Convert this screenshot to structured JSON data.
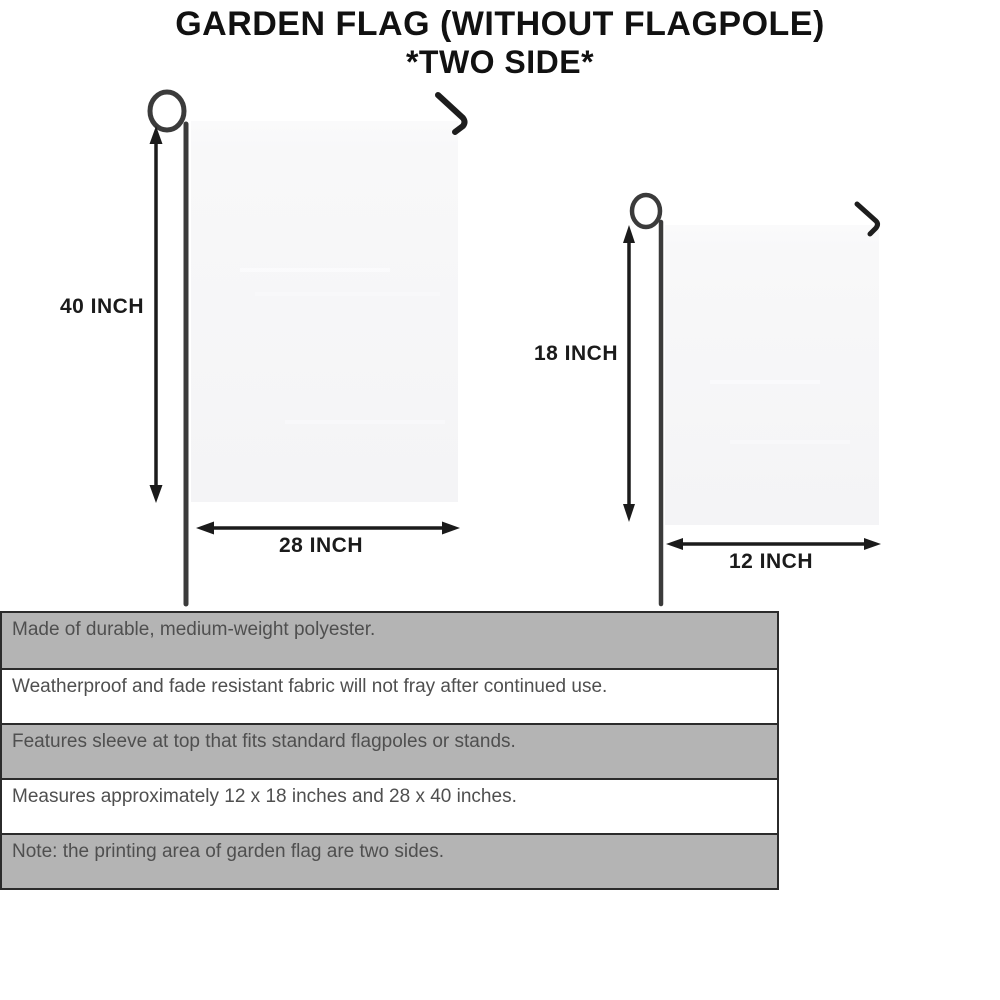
{
  "title": {
    "line1": "GARDEN FLAG (WITHOUT FLAGPOLE)",
    "line2": "*TWO SIDE*"
  },
  "diagram": {
    "large_flag": {
      "height_label": "40 INCH",
      "width_label": "28 INCH"
    },
    "small_flag": {
      "height_label": "18 INCH",
      "width_label": "12 INCH"
    }
  },
  "features": [
    {
      "text": "Made of durable, medium-weight polyester.",
      "background": "gray"
    },
    {
      "text": "Weatherproof and fade resistant fabric will not fray after continued use.",
      "background": "white"
    },
    {
      "text": "Features sleeve at top that fits standard flagpoles or stands.",
      "background": "gray"
    },
    {
      "text": "Measures approximately 12 x 18 inches and 28 x 40 inches.",
      "background": "white"
    },
    {
      "text": "Note: the printing area of garden flag are two sides.",
      "background": "gray"
    }
  ],
  "colors": {
    "row_gray": "#b4b4b4",
    "row_white": "#ffffff",
    "row_border": "#2b2b2b",
    "feature_text": "#4f4f4f",
    "title_text": "#111111",
    "flag_fill": "#f6f6f7",
    "pole": "#3b3b3b",
    "hook": "#1d1d1d",
    "arrow": "#1b1b1b"
  }
}
